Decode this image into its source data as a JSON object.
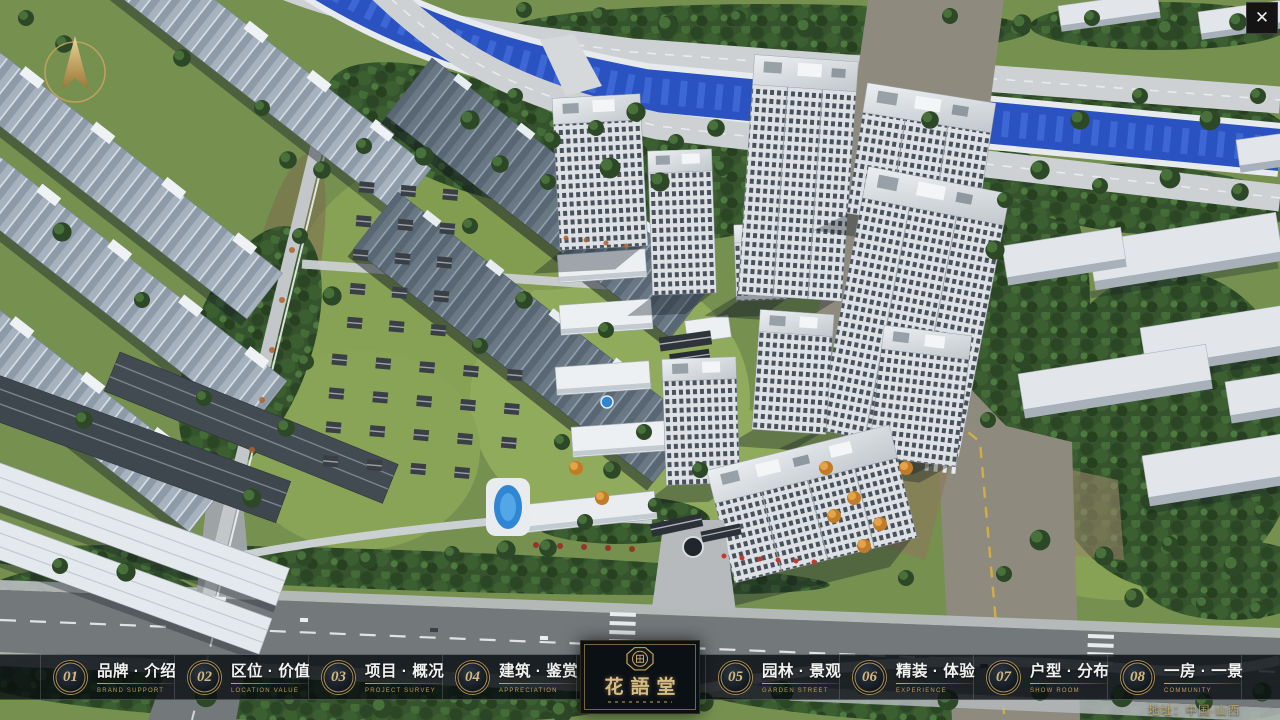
{
  "app": {
    "close_label": "✕",
    "address": "地址：中国·山西"
  },
  "logo": {
    "title": "花語堂"
  },
  "nav": {
    "items": [
      {
        "num": "01",
        "label": "品牌 · 介绍",
        "en": "BRAND SUPPORT"
      },
      {
        "num": "02",
        "label": "区位 · 价值",
        "en": "LOCATION VALUE"
      },
      {
        "num": "03",
        "label": "项目 · 概况",
        "en": "PROJECT SURVEY"
      },
      {
        "num": "04",
        "label": "建筑 · 鉴赏",
        "en": "APPRECIATION"
      },
      {
        "num": "05",
        "label": "园林 · 景观",
        "en": "GARDEN STREET"
      },
      {
        "num": "06",
        "label": "精装 · 体验",
        "en": "EXPERIENCE"
      },
      {
        "num": "07",
        "label": "户型 · 分布",
        "en": "SHOW ROOM"
      },
      {
        "num": "08",
        "label": "一房 · 一景",
        "en": "COMMUNITY"
      }
    ]
  },
  "colors": {
    "gold": "#c8a55e",
    "bar_bg": "rgba(8,13,18,0.8)",
    "water": "#2a52c0",
    "label_text": "#f2f3f1"
  }
}
